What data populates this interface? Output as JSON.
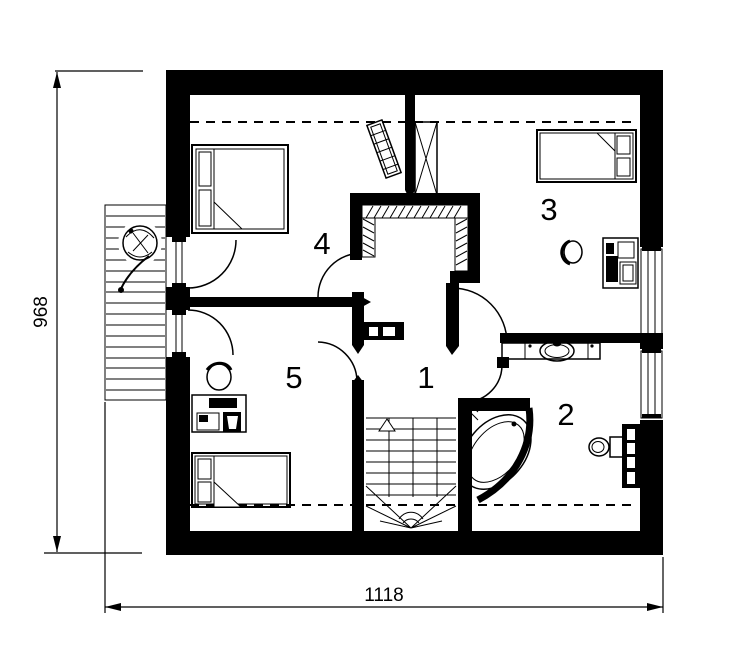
{
  "rooms": [
    {
      "number": "1"
    },
    {
      "number": "2"
    },
    {
      "number": "3"
    },
    {
      "number": "4"
    },
    {
      "number": "5"
    }
  ],
  "dimensions": {
    "width": "1118",
    "height": "968"
  },
  "colors": {
    "ink": "#000000",
    "paper": "#ffffff"
  },
  "icons": [
    "double-bed",
    "single-bed",
    "desk-with-computer",
    "office-chair",
    "walk-in-closet-rail",
    "staircase-up",
    "corner-bathtub",
    "toilet",
    "washbasin-counter",
    "radiator",
    "potted-plant",
    "balcony-deck",
    "chimney-shaft",
    "balcony-door",
    "door-swing",
    "window",
    "dresser"
  ]
}
